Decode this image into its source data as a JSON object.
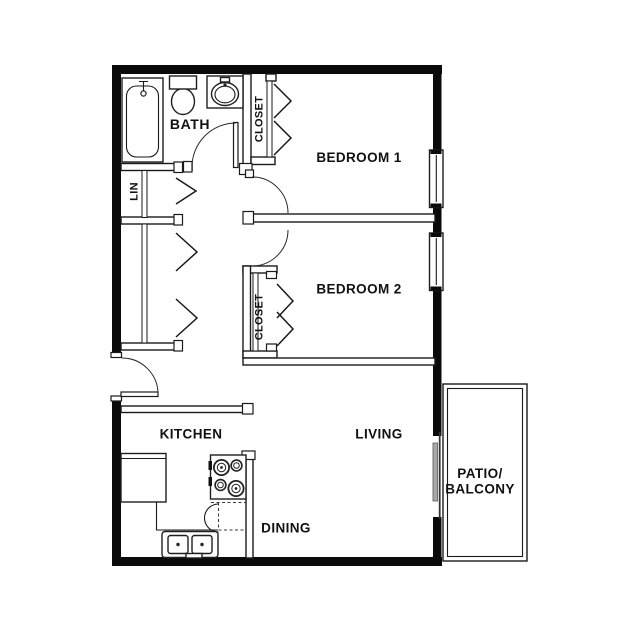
{
  "floorplan": {
    "labels": {
      "bath": "BATH",
      "bedroom1": "BEDROOM 1",
      "bedroom2": "BEDROOM 2",
      "closet_bedroom1": "CLOSET",
      "closet_bedroom2": "CLOSET",
      "linen": "LIN",
      "kitchen": "KITCHEN",
      "living": "LIVING",
      "dining": "DINING",
      "patio_line1": "PATIO/",
      "patio_line2": "BALCONY"
    },
    "fixture_icons": [
      "bathtub-icon",
      "toilet-icon",
      "bathroom-sink-icon",
      "stove-icon",
      "refrigerator-icon",
      "kitchen-sink-icon",
      "dishwasher-icon",
      "window-icon",
      "sliding-door-icon",
      "bifold-door-icon",
      "swing-door-icon"
    ],
    "colors": {
      "walls": "#0a0a0a",
      "lines": "#1a1a1a",
      "background": "#ffffff",
      "sliding_door_panel": "#a9a9a9"
    }
  }
}
